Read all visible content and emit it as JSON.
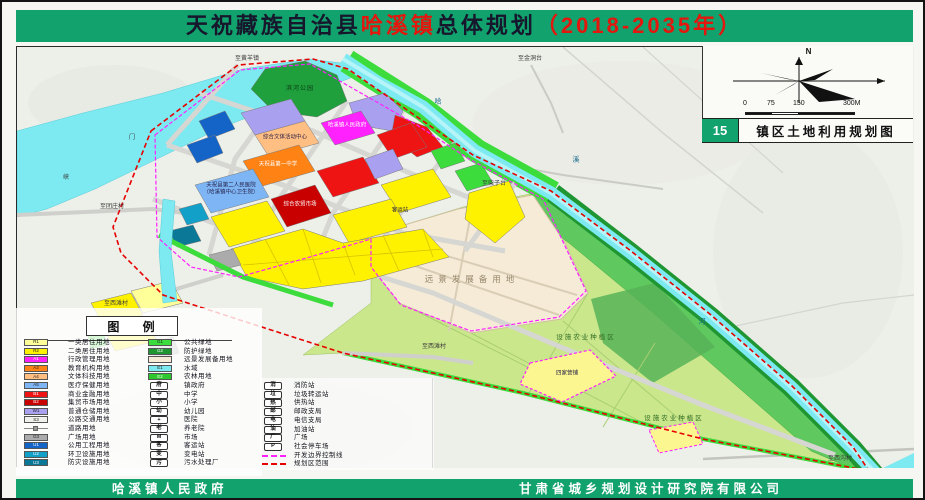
{
  "banner": {
    "parts": [
      "天祝藏族自治县",
      "哈溪镇",
      "总体规划",
      "（2018-2035年）"
    ]
  },
  "info_panel": {
    "north_label": "N",
    "sheet_number": "15",
    "sheet_title": "镇区土地利用规划图"
  },
  "scalebar": {
    "labels": [
      "0",
      "75",
      "150",
      "300M"
    ]
  },
  "legend": {
    "title": "图 例",
    "columns": [
      [
        {
          "sw": "c",
          "color": "#FFFF99",
          "code": "R1",
          "label": "一类居住用地"
        },
        {
          "sw": "c",
          "color": "#FFF200",
          "code": "R2",
          "label": "二类居住用地"
        },
        {
          "sw": "c",
          "color": "#FF22FF",
          "code": "A1",
          "label": "行政管理用地",
          "lt": true
        },
        {
          "sw": "c",
          "color": "#FF8214",
          "code": "A3",
          "label": "教育机构用地"
        },
        {
          "sw": "c",
          "color": "#FFBE82",
          "code": "A4",
          "label": "文体科技用地"
        },
        {
          "sw": "c",
          "color": "#7EB6F5",
          "code": "A5",
          "label": "医疗保健用地"
        },
        {
          "sw": "c",
          "color": "#EE1414",
          "code": "B1",
          "label": "商业金融用地",
          "lt": true
        },
        {
          "sw": "c",
          "color": "#C80000",
          "code": "B2",
          "label": "集贸市场用地",
          "lt": true
        },
        {
          "sw": "c",
          "color": "#A9A0F0",
          "code": "W1",
          "label": "普通仓储用地"
        },
        {
          "sw": "c",
          "color": "#F0F0EC",
          "code": "S3",
          "label": "公路交通用地"
        },
        {
          "sw": "road",
          "label": "道路用地"
        },
        {
          "sw": "c",
          "color": "#ABABAB",
          "code": "G3",
          "label": "广场用地"
        },
        {
          "sw": "c",
          "color": "#1464C8",
          "code": "U1",
          "label": "公用工程用地",
          "lt": true
        },
        {
          "sw": "c",
          "color": "#12A0C8",
          "code": "U2",
          "label": "环卫设施用地",
          "lt": true
        },
        {
          "sw": "c",
          "color": "#0A7896",
          "code": "U3",
          "label": "防灾设施用地",
          "lt": true
        }
      ],
      [
        {
          "sw": "c",
          "color": "#3CDC3C",
          "code": "G1",
          "label": "公共绿地"
        },
        {
          "sw": "c",
          "color": "#1F9632",
          "code": "G2",
          "label": "防护绿地",
          "lt": true
        },
        {
          "sw": "c",
          "color": "#F5EBD7",
          "code": "",
          "label": "远景发展备用地"
        },
        {
          "sw": "c",
          "color": "#7DE9F0",
          "code": "E1",
          "label": "水域"
        },
        {
          "sw": "c",
          "color": "#2DC82D",
          "code": "E2",
          "label": "农林用地",
          "lt": true
        },
        {
          "sw": "sym",
          "glyph": "府",
          "label": "镇政府"
        },
        {
          "sw": "sym",
          "glyph": "中",
          "label": "中学"
        },
        {
          "sw": "sym",
          "glyph": "小",
          "label": "小学"
        },
        {
          "sw": "sym",
          "glyph": "幼",
          "label": "幼儿园"
        },
        {
          "sw": "sym",
          "glyph": "+",
          "label": "医院"
        },
        {
          "sw": "sym",
          "glyph": "老",
          "label": "养老院"
        },
        {
          "sw": "sym",
          "glyph": "M",
          "label": "市场"
        },
        {
          "sw": "sym",
          "glyph": "客",
          "label": "客运站"
        },
        {
          "sw": "sym",
          "glyph": "变",
          "label": "变电站"
        },
        {
          "sw": "sym",
          "glyph": "污",
          "label": "污水处理厂"
        }
      ],
      [
        {
          "sw": "sym",
          "glyph": "消",
          "label": "消防站"
        },
        {
          "sw": "sym",
          "glyph": "垃",
          "label": "垃圾转运站"
        },
        {
          "sw": "sym",
          "glyph": "热",
          "label": "供热站"
        },
        {
          "sw": "sym",
          "glyph": "邮",
          "label": "邮政支局"
        },
        {
          "sw": "sym",
          "glyph": "电",
          "label": "电信支局"
        },
        {
          "sw": "sym",
          "glyph": "油",
          "label": "加油站"
        },
        {
          "sw": "sym",
          "glyph": "广",
          "label": "广场"
        },
        {
          "sw": "sym",
          "glyph": "P",
          "label": "社会停车场"
        },
        {
          "sw": "line",
          "color": "#FF22FF",
          "label": "开发边界控制线"
        },
        {
          "sw": "line",
          "color": "#E60000",
          "label": "规划区范围"
        }
      ]
    ]
  },
  "footer": {
    "left": "哈溪镇人民政府",
    "right": "甘肃省城乡规划设计研究院有限公司"
  },
  "map": {
    "labels": [
      {
        "t": "至黄羊镇",
        "x": 245,
        "y": 57,
        "cls": "rd"
      },
      {
        "t": "至金洞台",
        "x": 528,
        "y": 57,
        "cls": "rd"
      },
      {
        "t": "至柴子台",
        "x": 492,
        "y": 182,
        "cls": "rd"
      },
      {
        "t": "至团庄村",
        "x": 110,
        "y": 205,
        "cls": "rd"
      },
      {
        "t": "至西滩村",
        "x": 114,
        "y": 302,
        "cls": "rd"
      },
      {
        "t": "至西滩村",
        "x": 432,
        "y": 345,
        "cls": "rd"
      },
      {
        "t": "至西沟村",
        "x": 838,
        "y": 457,
        "cls": "rd"
      },
      {
        "t": "峡",
        "x": 64,
        "y": 176,
        "cls": "rd"
      },
      {
        "t": "门",
        "x": 130,
        "y": 136,
        "cls": "rd"
      },
      {
        "t": "哈",
        "x": 436,
        "y": 100,
        "cls": "rv"
      },
      {
        "t": "溪",
        "x": 574,
        "y": 158,
        "cls": "rv"
      },
      {
        "t": "河",
        "x": 700,
        "y": 320,
        "cls": "rv"
      },
      {
        "t": "滨河公园",
        "x": 298,
        "y": 87,
        "cls": "pk"
      },
      {
        "t": "综合文体活动中心",
        "x": 283,
        "y": 136,
        "cls": "fd"
      },
      {
        "t": "哈溪镇人民政府",
        "x": 345,
        "y": 124,
        "cls": "fw"
      },
      {
        "t": "天祝县第一中学",
        "x": 276,
        "y": 163,
        "cls": "fw"
      },
      {
        "t": "天祝县第二人民医院",
        "x": 229,
        "y": 184,
        "cls": "fd"
      },
      {
        "t": "（哈溪镇中心卫生院）",
        "x": 229,
        "y": 191,
        "cls": "fd"
      },
      {
        "t": "综合农贸市场",
        "x": 298,
        "y": 203,
        "cls": "fw"
      },
      {
        "t": "客运站",
        "x": 398,
        "y": 209,
        "cls": "fd"
      },
      {
        "t": "远景发展备用地",
        "x": 470,
        "y": 277,
        "cls": "rs"
      },
      {
        "t": "设施农业种植区",
        "x": 584,
        "y": 336,
        "cls": "ag"
      },
      {
        "t": "设施农业种植区",
        "x": 672,
        "y": 417,
        "cls": "ag"
      },
      {
        "t": "四家营铺",
        "x": 565,
        "y": 372,
        "cls": "fd"
      }
    ]
  },
  "colors": {
    "banner_green": "#12a26d",
    "title_red": "#e3170d",
    "boundary_red": "#e60000",
    "dev_boundary_magenta": "#ff22ff",
    "water_cyan": "#7de9f0"
  }
}
